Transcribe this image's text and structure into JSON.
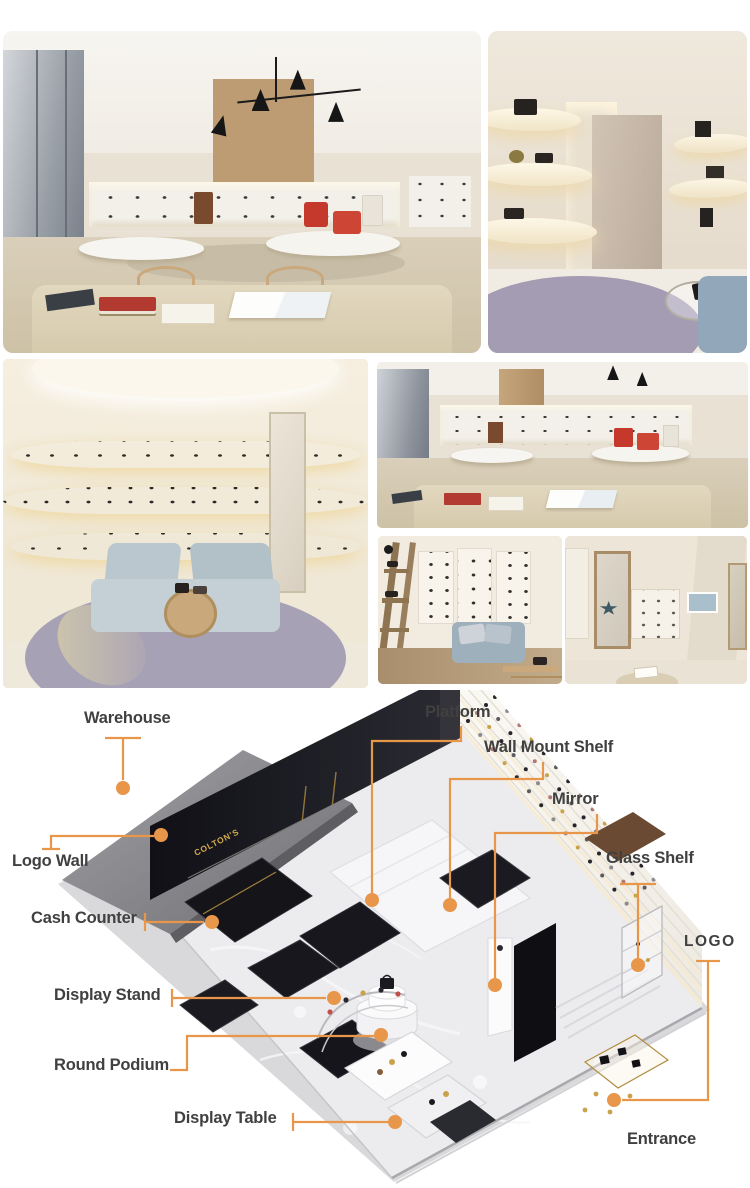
{
  "colors": {
    "accent": "#e8964a",
    "label_text": "#404040",
    "wall_logo_gold": "#d2a74f",
    "black_marble": "#15151a",
    "white_marble": "#ececee"
  },
  "diagram": {
    "wall_logo": "COLTON'S",
    "labels": [
      {
        "id": "warehouse",
        "text": "Warehouse"
      },
      {
        "id": "platform",
        "text": "Platform"
      },
      {
        "id": "wall-mount-shelf",
        "text": "Wall Mount Shelf"
      },
      {
        "id": "mirror",
        "text": "Mirror"
      },
      {
        "id": "logo-wall",
        "text": "Logo Wall"
      },
      {
        "id": "glass-shelf",
        "text": "Glass Shelf"
      },
      {
        "id": "cash-counter",
        "text": "Cash Counter"
      },
      {
        "id": "logo",
        "text": "LOGO"
      },
      {
        "id": "display-stand",
        "text": "Display Stand"
      },
      {
        "id": "round-podium",
        "text": "Round Podium"
      },
      {
        "id": "display-table",
        "text": "Display Table"
      },
      {
        "id": "entrance",
        "text": "Entrance"
      }
    ]
  }
}
